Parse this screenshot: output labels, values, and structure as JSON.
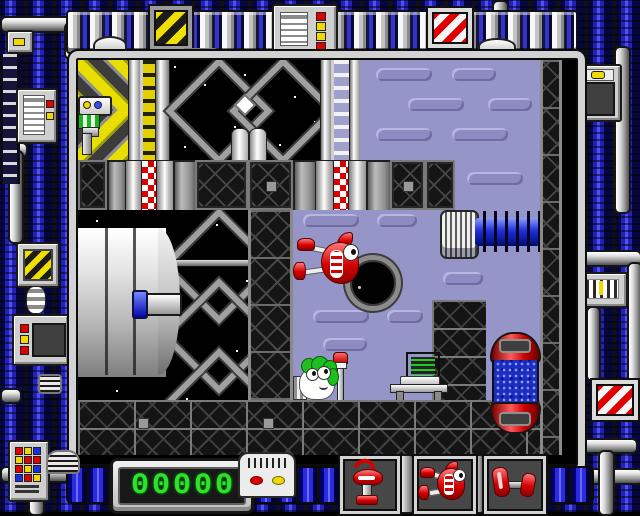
{
  "scene": {
    "type": "retro-puzzle-game-screen",
    "regions": [
      "mechanical-border",
      "playfield",
      "score-hud",
      "tool-slots"
    ]
  },
  "scoreboard": {
    "score": "00000",
    "digits": [
      "0",
      "0",
      "0",
      "0",
      "0"
    ],
    "led_color": "#2ce22c"
  },
  "hud": {
    "slots": [
      {
        "id": "drill-robot",
        "description": "red robot tool on pedestal"
      },
      {
        "id": "plunger-bird",
        "description": "red bird with suction-cup feet"
      },
      {
        "id": "dumbbell",
        "description": "pair of red weights with grey bar"
      }
    ]
  },
  "playfield": {
    "sprites": [
      {
        "id": "peek-machine",
        "description": "machine with eyes peeking from left wall"
      },
      {
        "id": "plunger-bird",
        "description": "red bird climbing the dark column"
      },
      {
        "id": "green-gremlin",
        "description": "green-haired creature on the floor"
      },
      {
        "id": "signal-pole",
        "description": "white pole with red cap"
      },
      {
        "id": "computer-desk",
        "description": "terminal with green code on a table"
      },
      {
        "id": "black-hole",
        "description": "round hole in the purple wall"
      },
      {
        "id": "capsule-tank",
        "description": "red capped tank with blue bubbling liquid"
      },
      {
        "id": "ribbed-barrel",
        "description": "grey ribbed drum"
      },
      {
        "id": "coil-spring",
        "description": "blue coil spring"
      },
      {
        "id": "rocket-cylinder",
        "description": "large grey cylinder with blue probe"
      },
      {
        "id": "twin-cylinders",
        "description": "two small white canisters"
      }
    ],
    "signs": [
      {
        "id": "hazard-yellow-sign"
      },
      {
        "id": "warning-stripes-sign-top"
      },
      {
        "id": "warning-stripes-sign-bottom"
      }
    ]
  },
  "colors": {
    "border_blue": "#2a2ae0",
    "border_blue_dark": "#07073f",
    "pipe_light": "#f0f0f0",
    "wall_purple": "#9695c7",
    "wall_purple_light": "#b7b5e2",
    "wall_purple_dark": "#6e6ca3",
    "hazard_yellow": "#e8df00",
    "alert_red": "#d40000",
    "led_green": "#2ce22c",
    "coil_blue": "#2030d8",
    "space_black": "#000000"
  }
}
